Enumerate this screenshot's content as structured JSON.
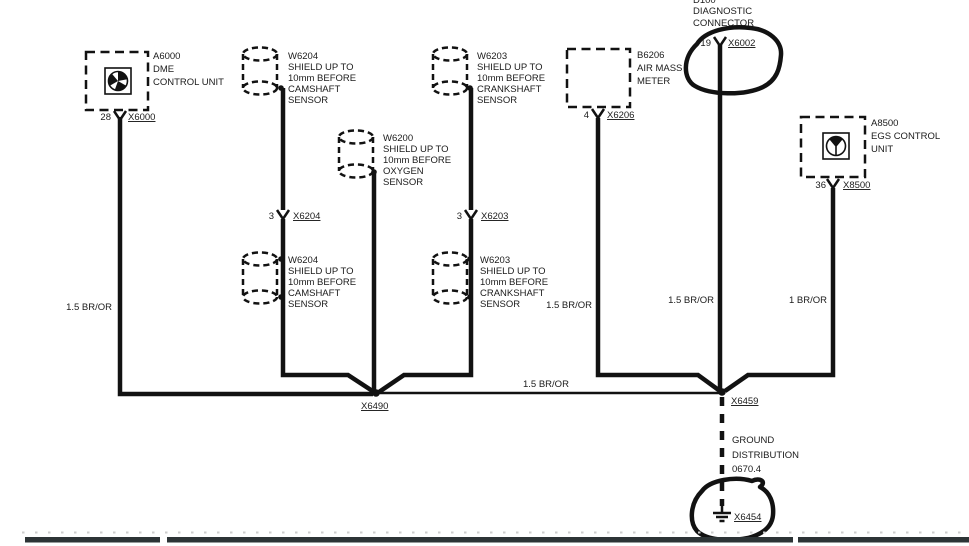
{
  "diagram": {
    "dme": {
      "id": "A6000",
      "name1": "DME",
      "name2": "CONTROL UNIT",
      "pin": "28",
      "connector": "X6000",
      "wire_label": "1.5 BR/OR"
    },
    "shield_cam_top": {
      "id": "W6204",
      "l1": "SHIELD UP TO",
      "l2": "10mm BEFORE",
      "l3": "CAMSHAFT",
      "l4": "SENSOR"
    },
    "shield_oxygen": {
      "id": "W6200",
      "l1": "SHIELD UP TO",
      "l2": "10mm BEFORE",
      "l3": "OXYGEN",
      "l4": "SENSOR"
    },
    "shield_crank_top": {
      "id": "W6203",
      "l1": "SHIELD UP TO",
      "l2": "10mm BEFORE",
      "l3": "CRANKSHAFT",
      "l4": "SENSOR"
    },
    "shield_cam_bottom": {
      "id": "W6204",
      "l1": "SHIELD UP TO",
      "l2": "10mm BEFORE",
      "l3": "CAMSHAFT",
      "l4": "SENSOR"
    },
    "shield_crank_bottom": {
      "id": "W6203",
      "l1": "SHIELD UP TO",
      "l2": "10mm BEFORE",
      "l3": "CRANKSHAFT",
      "l4": "SENSOR"
    },
    "conn_cam": {
      "pin": "3",
      "connector": "X6204"
    },
    "conn_crank": {
      "pin": "3",
      "connector": "X6203"
    },
    "air_mass_meter": {
      "id": "B6206",
      "name1": "AIR MASS",
      "name2": "METER",
      "pin": "4",
      "connector": "X6206",
      "wire_label": "1.5 BR/OR"
    },
    "diagnostic_connector": {
      "id_partial": "D100",
      "name1": "DIAGNOSTIC",
      "name2": "CONNECTOR",
      "pin": "19",
      "connector": "X6002",
      "wire_label": "1.5 BR/OR"
    },
    "egs": {
      "id": "A8500",
      "name1": "EGS CONTROL",
      "name2": "UNIT",
      "pin": "36",
      "connector": "X8500",
      "wire_label": "1 BR/OR"
    },
    "junction_left": {
      "connector": "X6490"
    },
    "junction_right": {
      "connector": "X6459"
    },
    "bus_wire_label": "1.5 BR/OR",
    "ground": {
      "l1": "GROUND",
      "l2": "DISTRIBUTION",
      "l3": "0670.4",
      "connector": "X6454"
    },
    "colors": {
      "line": "#121212",
      "background": "#ffffff"
    }
  }
}
